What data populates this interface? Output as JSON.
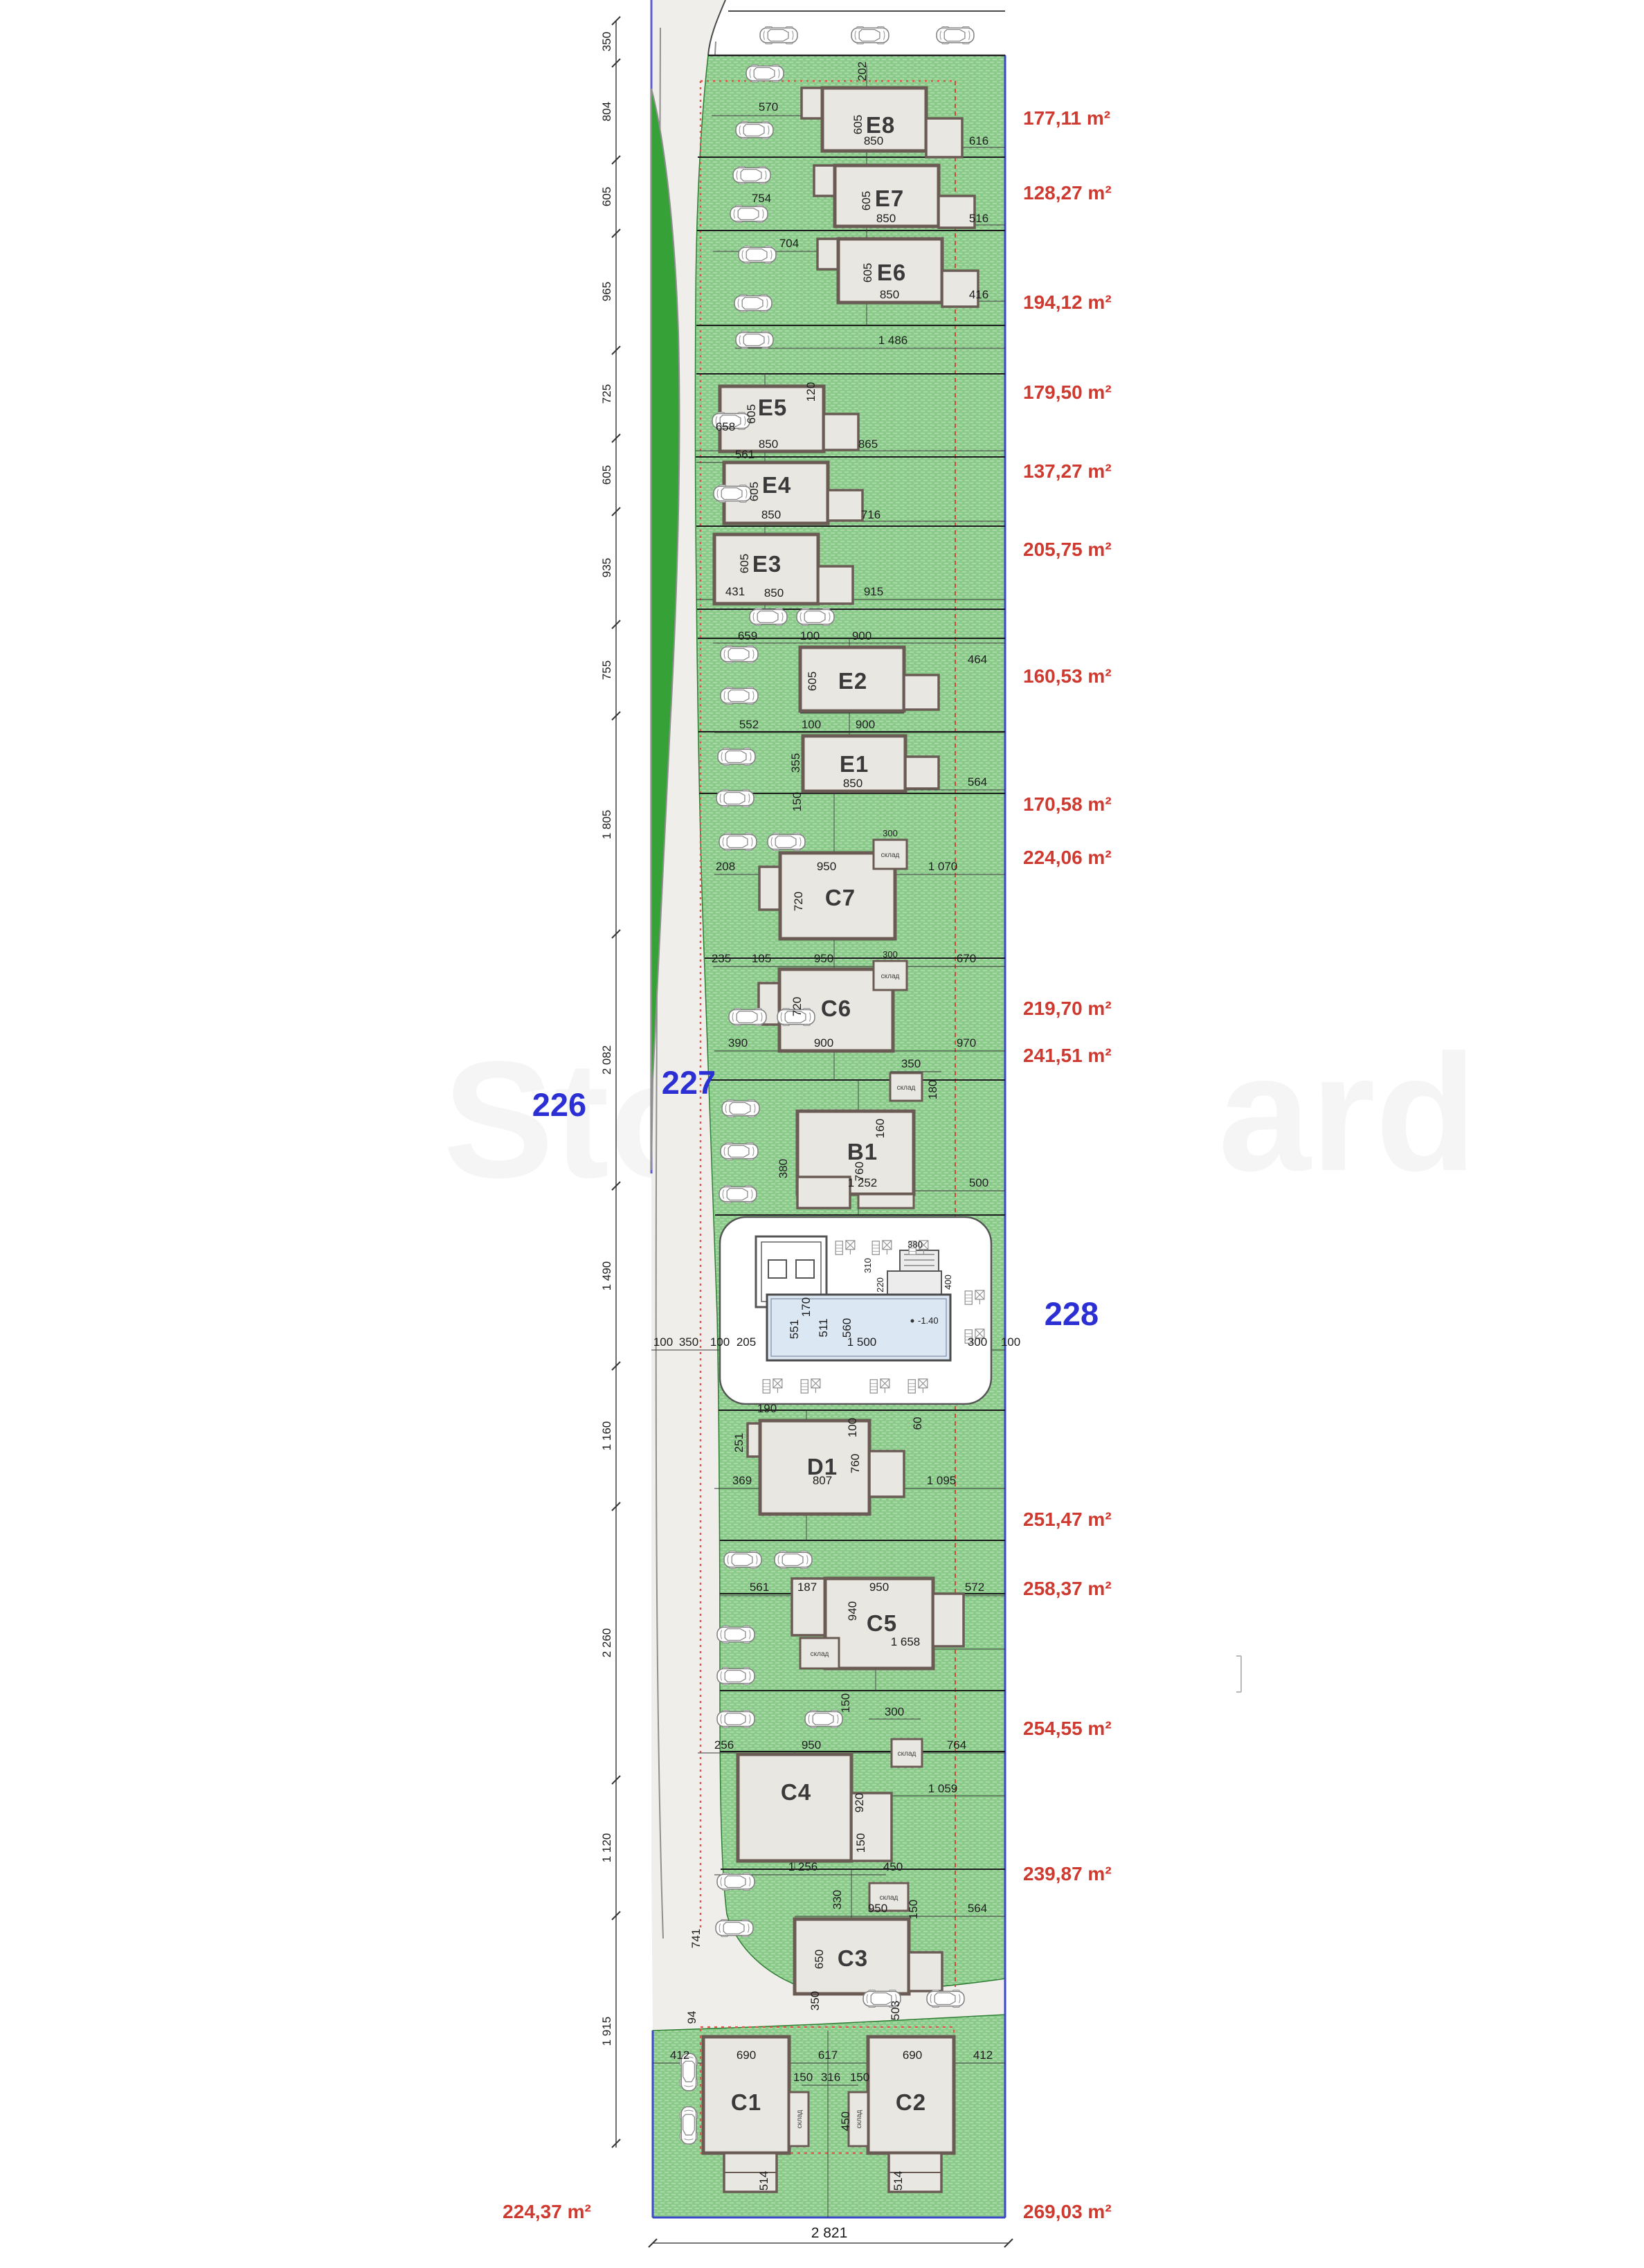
{
  "parcels": {
    "left": "226",
    "road": "227",
    "common": "228"
  },
  "left_chain": [
    "350",
    "804",
    "605",
    "965",
    "725",
    "605",
    "935",
    "755",
    "1 805",
    "2 082",
    "1 490",
    "1 160",
    "2 260",
    "1 120",
    "1 915"
  ],
  "bottom_total": "2 821",
  "shed": "склад",
  "watermark": {
    "left": "Sto",
    "right": "ard"
  },
  "plots": [
    {
      "name": "E8",
      "area": "177,11 m²",
      "dims": [
        "570",
        "202",
        "605",
        "850",
        "616"
      ]
    },
    {
      "name": "E7",
      "area": "128,27 m²",
      "dims": [
        "754",
        "605",
        "850",
        "516"
      ]
    },
    {
      "name": "E6",
      "area": "194,12 m²",
      "dims": [
        "704",
        "605",
        "850",
        "416",
        "1 486"
      ]
    },
    {
      "name": "E5",
      "area": "179,50 m²",
      "dims": [
        "658",
        "120",
        "605",
        "850",
        "865"
      ]
    },
    {
      "name": "E4",
      "area": "137,27 m²",
      "dims": [
        "561",
        "605",
        "850",
        "716"
      ]
    },
    {
      "name": "E3",
      "area": "205,75 m²",
      "dims": [
        "431",
        "605",
        "850",
        "915"
      ]
    },
    {
      "name": "E2",
      "area": "160,53 m²",
      "dims": [
        "659",
        "100",
        "900",
        "605",
        "464"
      ]
    },
    {
      "name": "E1",
      "area": "170,58 m²",
      "dims": [
        "552",
        "100",
        "900",
        "355",
        "850",
        "564",
        "150"
      ]
    },
    {
      "name": "C7",
      "area": "224,06 m²",
      "dims": [
        "208",
        "950",
        "300",
        "720",
        "1 070"
      ]
    },
    {
      "name": "C6",
      "area": "219,70 m²",
      "dims": [
        "235",
        "105",
        "950",
        "300",
        "670",
        "720",
        "390",
        "900",
        "970"
      ]
    },
    {
      "name": "B1",
      "area": "241,51 m²",
      "dims": [
        "350",
        "180",
        "160",
        "760",
        "380",
        "1 252",
        "500"
      ]
    },
    {
      "name": "D1",
      "area": "251,47 m²",
      "dims": [
        "190",
        "251",
        "100",
        "60",
        "369",
        "807",
        "760",
        "1 095"
      ]
    },
    {
      "name": "C5",
      "area": "258,37 m²",
      "dims": [
        "561",
        "187",
        "950",
        "572",
        "940",
        "1 658",
        "150",
        "300"
      ]
    },
    {
      "name": "C4",
      "area": "254,55 m²",
      "dims": [
        "256",
        "950",
        "764",
        "920",
        "150",
        "1 059"
      ]
    },
    {
      "name": "C3",
      "area": "239,87 m²",
      "dims": [
        "1 256",
        "450",
        "330",
        "150",
        "950",
        "564",
        "650"
      ]
    },
    {
      "name": "C1",
      "area": "224,37 m²",
      "dims": [
        "412",
        "690",
        "514"
      ]
    },
    {
      "name": "C2",
      "area": "269,03 m²",
      "dims": [
        "617",
        "690",
        "412",
        "150",
        "316",
        "150",
        "450",
        "514"
      ]
    }
  ],
  "road_dims": [
    "741",
    "94",
    "350",
    "503"
  ],
  "pool": {
    "chain": [
      "100",
      "350",
      "100",
      "205",
      "1 500",
      "300",
      "100"
    ],
    "inner": [
      "551",
      "511",
      "170",
      "560"
    ],
    "tech": [
      "380",
      "400",
      "220",
      "310"
    ],
    "depth": "-1.40"
  }
}
